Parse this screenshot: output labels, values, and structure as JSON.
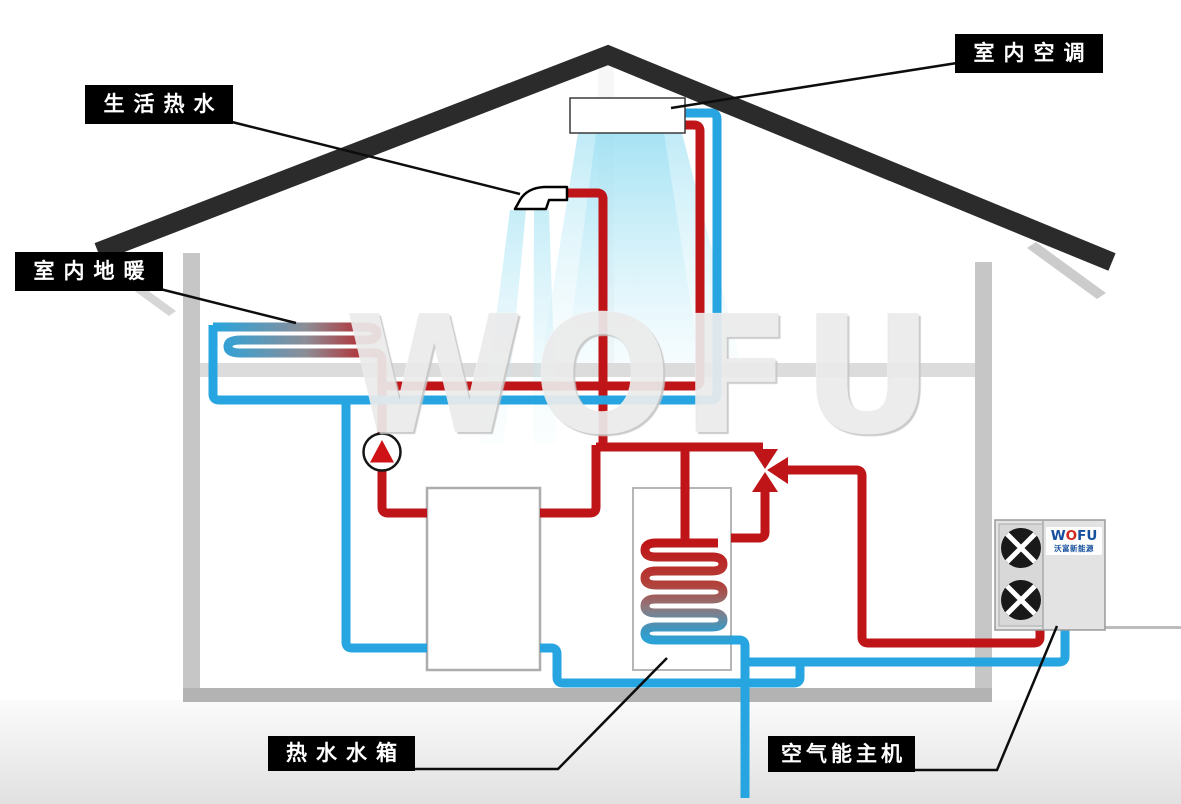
{
  "callouts": {
    "domestic_hot_water": {
      "label": "生活热水"
    },
    "indoor_ac": {
      "label": "室内空调"
    },
    "floor_heating": {
      "label": "室内地暖"
    },
    "hot_water_tank": {
      "label": "热水水箱"
    },
    "heat_pump_unit": {
      "label": "空气能主机"
    }
  },
  "watermark": {
    "text": "WOFU"
  },
  "outdoor_unit": {
    "brand_w": "W",
    "brand_o": "O",
    "brand_fu": "FU",
    "brand_cn": "沃富新能源"
  },
  "colors": {
    "hot_pipe": "#bf1418",
    "cold_pipe": "#26a5e0",
    "roof": "#2b2b2b",
    "wall": "#c6c6c6",
    "floor_slab": "#dcdcdc",
    "label_bg": "#000000",
    "label_text": "#ffffff",
    "air_spray": "#9adef2",
    "watermark_gray": "#ebebeb",
    "logo_blue": "#15509e",
    "logo_red": "#d3281c"
  }
}
